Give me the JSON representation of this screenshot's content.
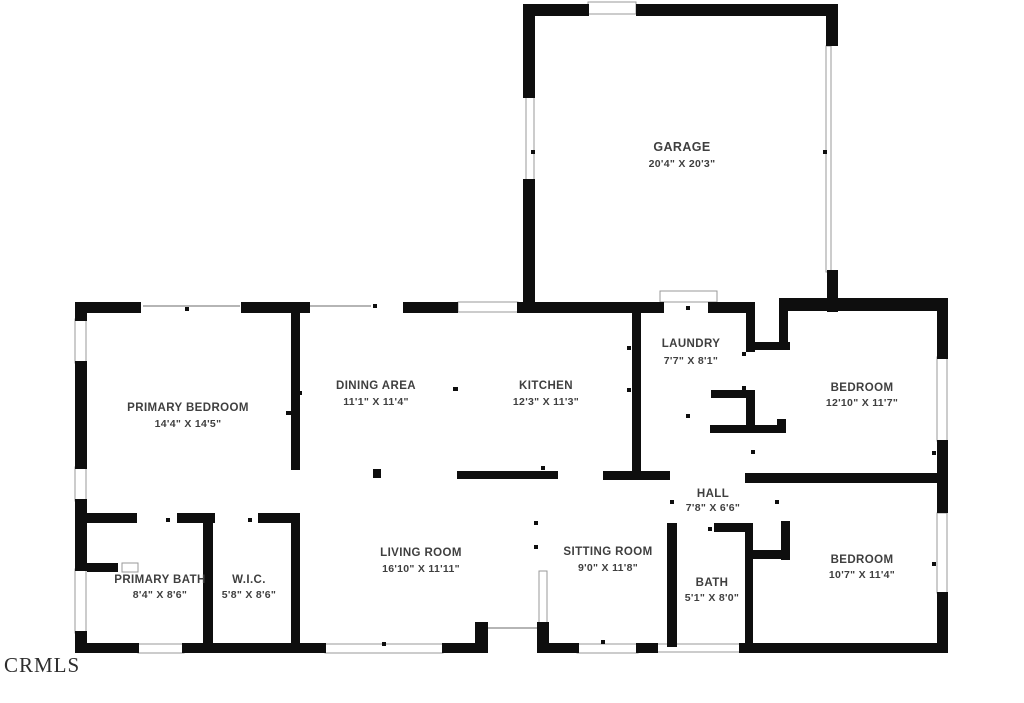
{
  "watermark": "CRMLS",
  "colors": {
    "wall": "#0e0e0e",
    "label": "#3f3f3f",
    "frame": "#999999",
    "thin": "#b5b5b5",
    "wm": "#2e2e2e",
    "bg": "#ffffff"
  },
  "rooms": [
    {
      "name": "GARAGE",
      "dims": "20'4\" X 20'3\""
    },
    {
      "name": "PRIMARY BEDROOM",
      "dims": "14'4\" X 14'5\""
    },
    {
      "name": "DINING AREA",
      "dims": "11'1\" X 11'4\""
    },
    {
      "name": "KITCHEN",
      "dims": "12'3\" X 11'3\""
    },
    {
      "name": "LAUNDRY",
      "dims": "7'7\" X 8'1\""
    },
    {
      "name": "BEDROOM",
      "dims": "12'10\" X 11'7\""
    },
    {
      "name": "HALL",
      "dims": "7'8\" X 6'6\""
    },
    {
      "name": "LIVING ROOM",
      "dims": "16'10\" X 11'11\""
    },
    {
      "name": "SITTING ROOM",
      "dims": "9'0\" X 11'8\""
    },
    {
      "name": "BATH",
      "dims": "5'1\" X 8'0\""
    },
    {
      "name": "BEDROOM",
      "dims": "10'7\" X 11'4\""
    },
    {
      "name": "PRIMARY BATH",
      "dims": "8'4\" X 8'6\""
    },
    {
      "name": "W.I.C.",
      "dims": "5'8\" X 8'6\""
    }
  ]
}
